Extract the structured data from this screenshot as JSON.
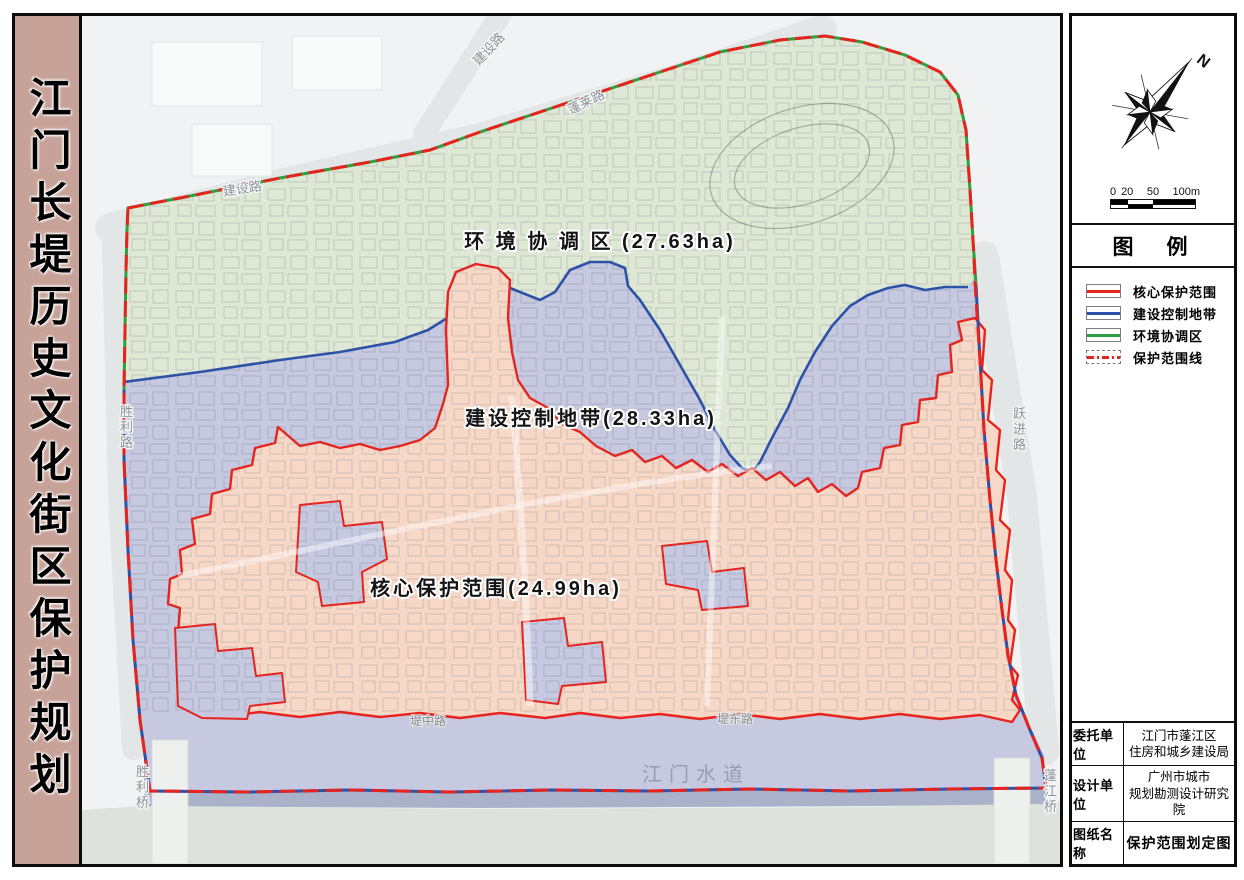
{
  "sheet": {
    "title_vertical": "江门长堤历史文化街区保护规划"
  },
  "map": {
    "zone_labels": {
      "coordination": "环 境 协 调 区 (27.63ha)",
      "control": "建设控制地带(28.33ha)",
      "core": "核心保护范围(24.99ha)"
    },
    "road_labels": {
      "jianshe_north": "建设路",
      "penglai": "蓬莱路",
      "jianshe_west": "建设路",
      "shengli_road": "胜利路",
      "yuejin_road": "跃进路",
      "dizhong_road": "堤中路",
      "didong_road": "堤东路",
      "shengli_bridge": "胜利桥",
      "pengjiang_bridge": "蓬江桥",
      "waterway": "江门水道"
    }
  },
  "compass": {
    "north": "N"
  },
  "scalebar": {
    "ticks": [
      "0",
      "20",
      "50",
      "100m"
    ]
  },
  "legend": {
    "title": "图　例",
    "items": [
      {
        "label": "核心保护范围",
        "color": "#e8231d",
        "line": "solid"
      },
      {
        "label": "建设控制地带",
        "color": "#2b51a8",
        "line": "solid"
      },
      {
        "label": "环境协调区",
        "color": "#2f9e41",
        "line": "solid"
      },
      {
        "label": "保护范围线",
        "color": "#e8231d",
        "line": "dashdot"
      }
    ]
  },
  "info_table": {
    "rows": [
      {
        "label": "委托单位",
        "line1": "江门市蓬江区",
        "line2": "住房和城乡建设局",
        "bold": false
      },
      {
        "label": "设计单位",
        "line1": "广州市城市",
        "line2": "规划勘测设计研究院",
        "bold": false
      },
      {
        "label": "图纸名称",
        "line1": "保护范围划定图",
        "line2": "",
        "bold": true
      }
    ]
  },
  "colors": {
    "title_bar": "#c7a298",
    "core_fill": "#f7d8c6",
    "core_line": "#e8231d",
    "control_fill": "#c6c9e0",
    "control_line": "#2b51a8",
    "coordination_fill": "#dfe8d4",
    "coordination_line": "#2f9e41",
    "river": "#a9b2c9"
  }
}
